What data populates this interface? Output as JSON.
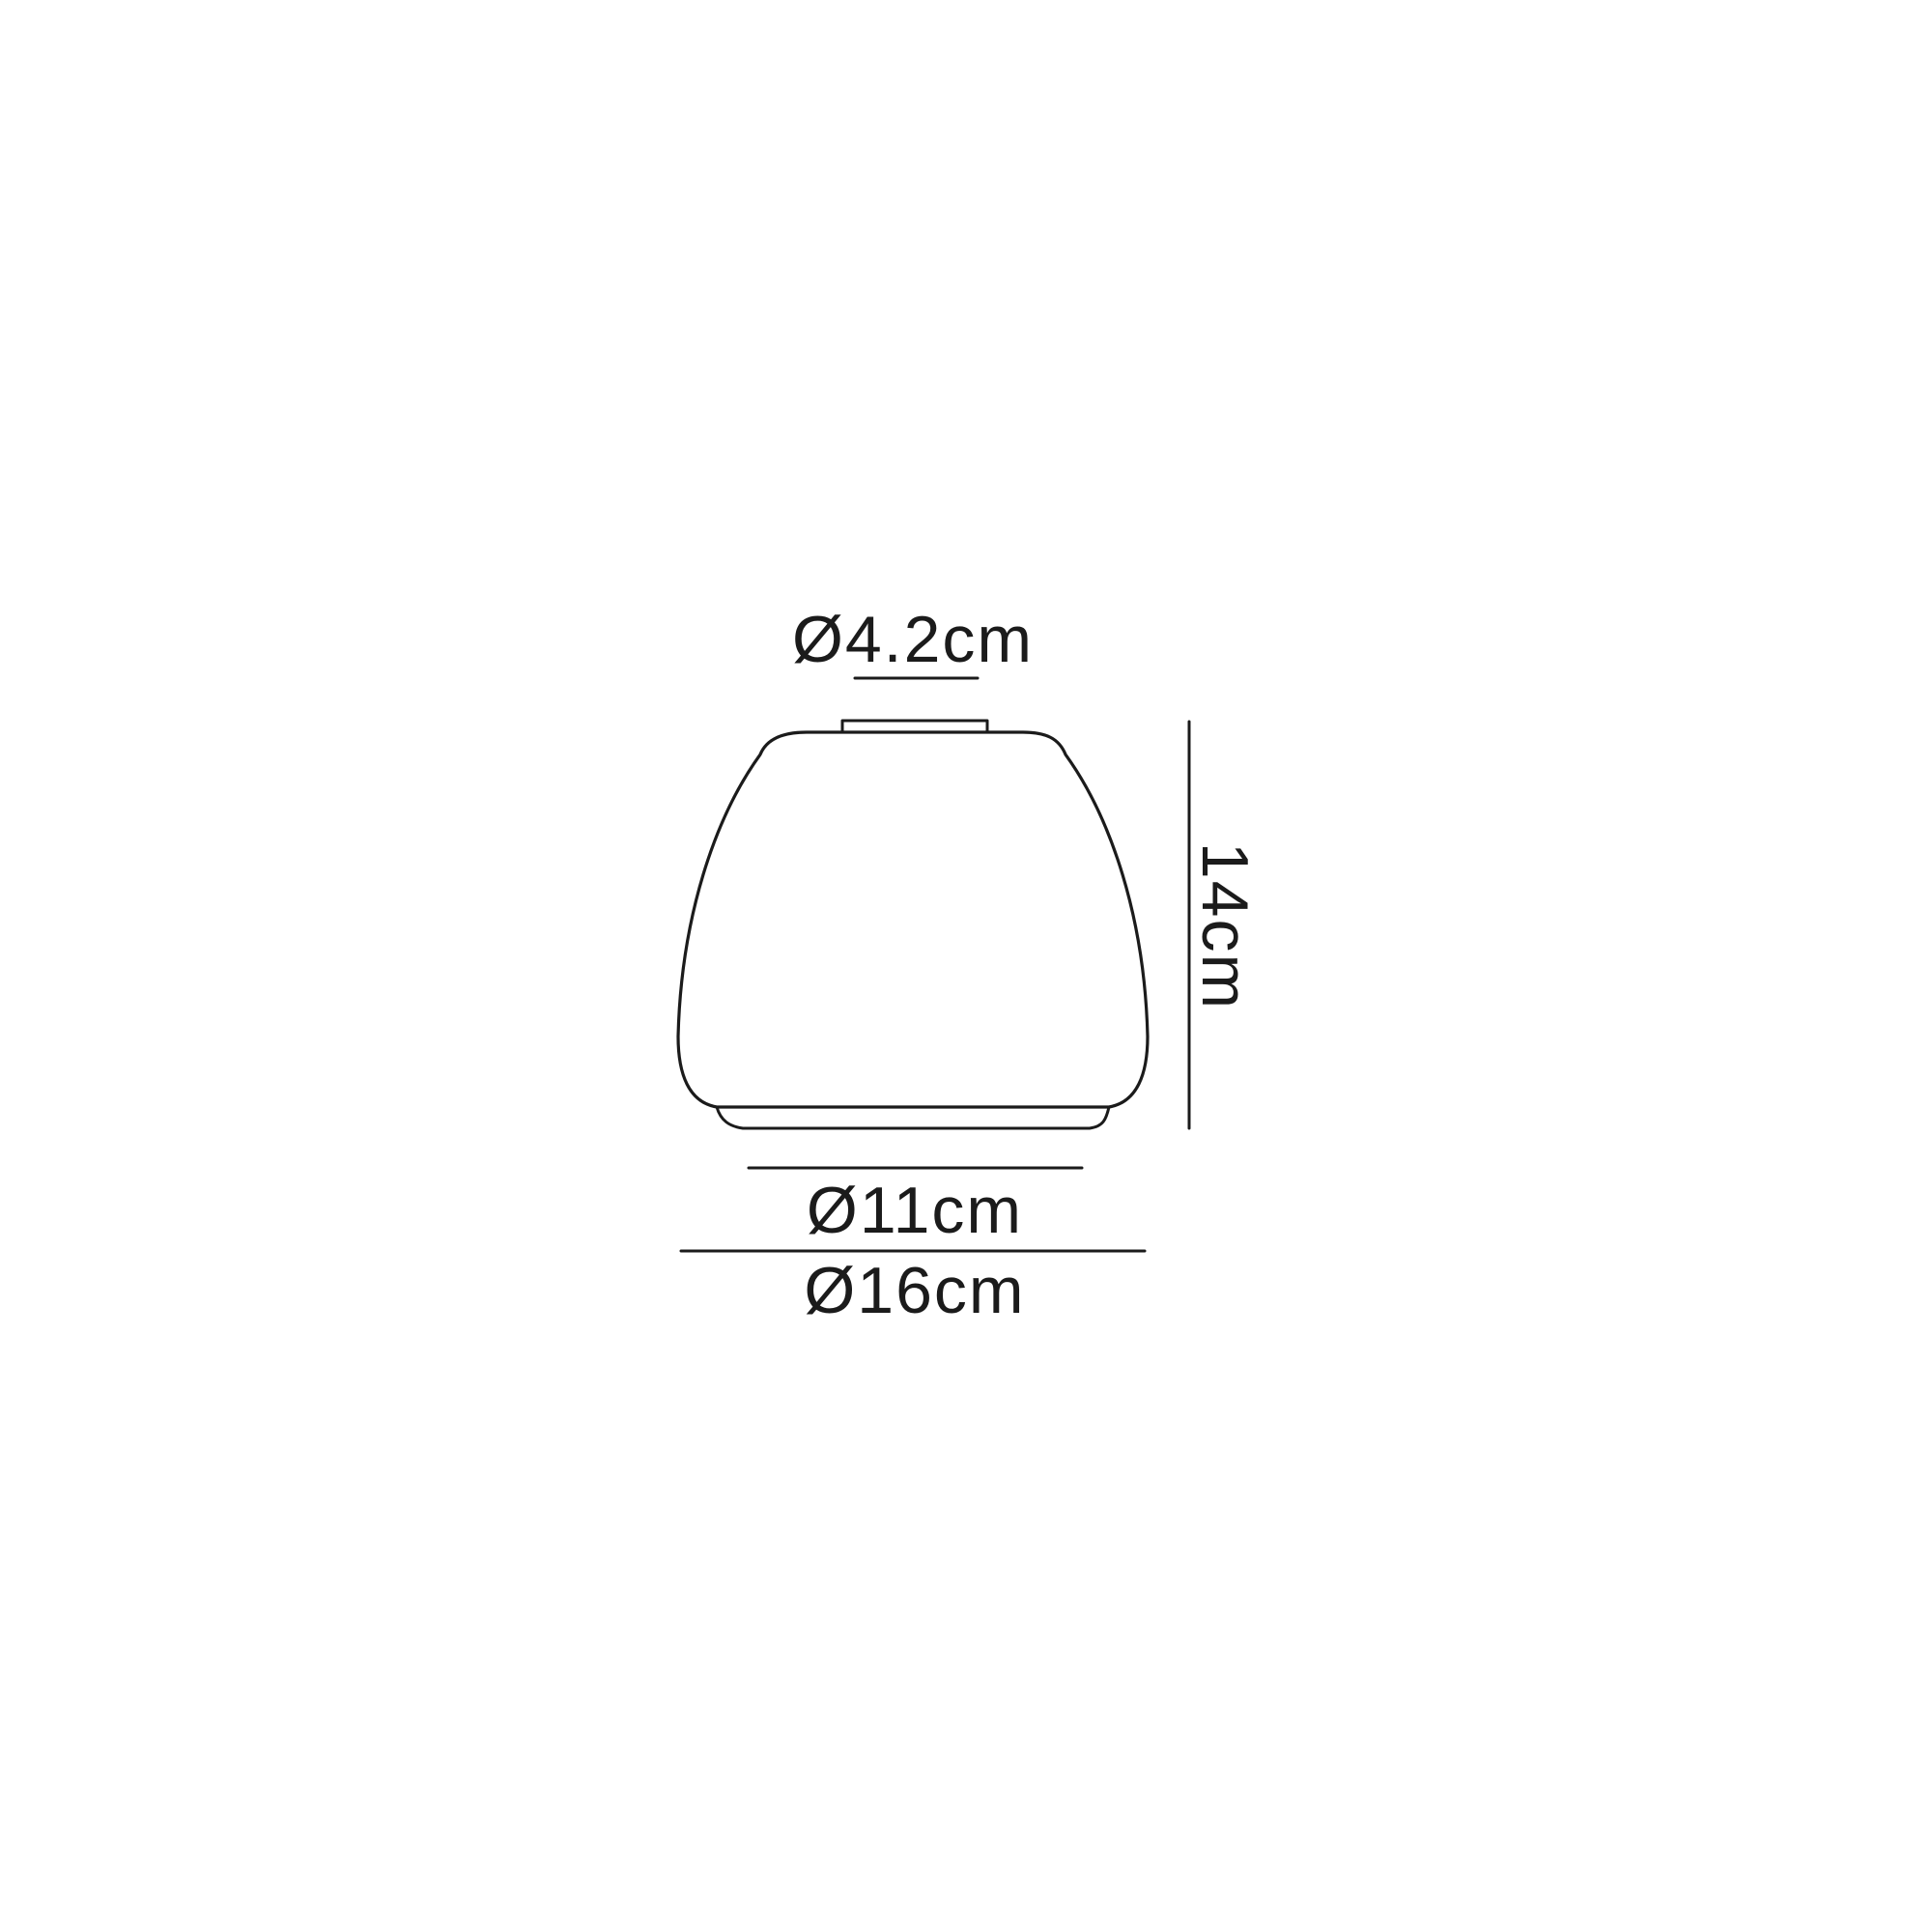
{
  "diagram": {
    "description": "Technical line drawing of a tapered glass lampshade with dimension annotations",
    "background_color": "#ffffff",
    "line_color": "#1b1b1b",
    "text_color": "#1b1b1b",
    "labels": {
      "top_diameter": "Ø4.2cm",
      "height": "14cm",
      "base_ring_diameter": "Ø11cm",
      "max_diameter": "Ø16cm"
    },
    "values_cm": {
      "top_diameter": 4.2,
      "height": 14,
      "base_ring_diameter": 11,
      "max_diameter": 16
    }
  }
}
